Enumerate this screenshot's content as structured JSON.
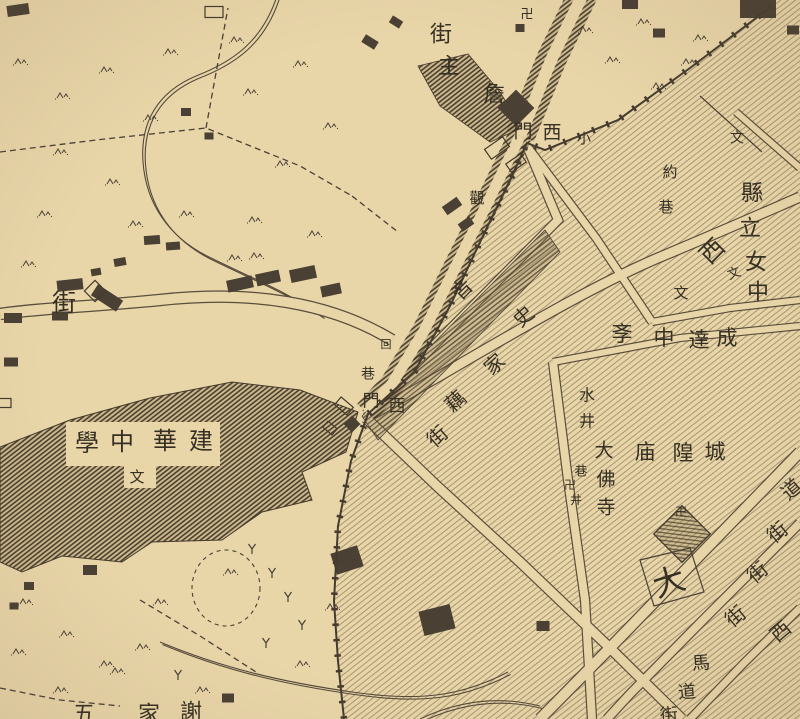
{
  "map": {
    "kind": "historical-city-map",
    "colors": {
      "paper": "#e8d5a8",
      "ink": "#3e362a",
      "ink_soft": "#5a4e3c",
      "building": "#4a4034",
      "text": "#352e24"
    },
    "place_names": [
      "詹主街",
      "小西門",
      "西門",
      "泉街",
      "回巷",
      "史家藕街",
      "觀",
      "約巷",
      "縣立女中",
      "西",
      "成達中斈",
      "城隍庙",
      "大佛寺",
      "水井",
      "巷井",
      "建華中學",
      "大",
      "道街",
      "街",
      "西街",
      "馬道街",
      "謝家五"
    ],
    "symbols": [
      "卍",
      "文",
      "回"
    ],
    "labels": [
      {
        "t": "卍",
        "x": 527,
        "y": 14,
        "s": 13
      },
      {
        "t": "街",
        "x": 441,
        "y": 34,
        "s": 22
      },
      {
        "t": "主",
        "x": 449,
        "y": 66,
        "s": 22
      },
      {
        "t": "詹",
        "x": 494,
        "y": 94,
        "s": 22
      },
      {
        "t": "門",
        "x": 523,
        "y": 132,
        "s": 19
      },
      {
        "t": "西",
        "x": 552,
        "y": 133,
        "s": 19
      },
      {
        "t": "小",
        "x": 584,
        "y": 140,
        "s": 14
      },
      {
        "t": "觀",
        "x": 477,
        "y": 199,
        "s": 15
      },
      {
        "t": "約",
        "x": 670,
        "y": 173,
        "s": 15
      },
      {
        "t": "巷",
        "x": 666,
        "y": 208,
        "s": 15
      },
      {
        "t": "文",
        "x": 737,
        "y": 139,
        "s": 14
      },
      {
        "t": "縣",
        "x": 752,
        "y": 193,
        "s": 22
      },
      {
        "t": "立",
        "x": 750,
        "y": 228,
        "s": 22
      },
      {
        "t": "女",
        "x": 756,
        "y": 262,
        "s": 22
      },
      {
        "t": "中",
        "x": 758,
        "y": 292,
        "s": 22
      },
      {
        "t": "西",
        "x": 713,
        "y": 252,
        "s": 24,
        "r": -45
      },
      {
        "t": "文",
        "x": 734,
        "y": 273,
        "s": 13,
        "r": -20
      },
      {
        "t": "文",
        "x": 681,
        "y": 294,
        "s": 15
      },
      {
        "t": "成",
        "x": 727,
        "y": 338,
        "s": 21
      },
      {
        "t": "達",
        "x": 699,
        "y": 340,
        "s": 21
      },
      {
        "t": "中",
        "x": 664,
        "y": 338,
        "s": 21
      },
      {
        "t": "斈",
        "x": 622,
        "y": 334,
        "s": 21
      },
      {
        "t": "音",
        "x": 463,
        "y": 290,
        "s": 20,
        "r": -45
      },
      {
        "t": "史",
        "x": 524,
        "y": 317,
        "s": 20,
        "r": -42
      },
      {
        "t": "家",
        "x": 495,
        "y": 365,
        "s": 20,
        "r": -42
      },
      {
        "t": "藕",
        "x": 456,
        "y": 402,
        "s": 20,
        "r": -42
      },
      {
        "t": "街",
        "x": 438,
        "y": 437,
        "s": 20,
        "r": -42
      },
      {
        "t": "回",
        "x": 386,
        "y": 345,
        "s": 11
      },
      {
        "t": "巷",
        "x": 368,
        "y": 375,
        "s": 14
      },
      {
        "t": "門",
        "x": 371,
        "y": 401,
        "s": 17
      },
      {
        "t": "西",
        "x": 397,
        "y": 406,
        "s": 17
      },
      {
        "t": "街",
        "x": 64,
        "y": 304,
        "s": 24
      },
      {
        "t": "建",
        "x": 201,
        "y": 442,
        "s": 24
      },
      {
        "t": "華",
        "x": 165,
        "y": 442,
        "s": 24
      },
      {
        "t": "中",
        "x": 122,
        "y": 443,
        "s": 24
      },
      {
        "t": "學",
        "x": 87,
        "y": 444,
        "s": 24
      },
      {
        "t": "文",
        "x": 137,
        "y": 478,
        "s": 15
      },
      {
        "t": "城",
        "x": 715,
        "y": 452,
        "s": 21
      },
      {
        "t": "隍",
        "x": 683,
        "y": 453,
        "s": 21
      },
      {
        "t": "庙",
        "x": 645,
        "y": 452,
        "s": 21
      },
      {
        "t": "大",
        "x": 604,
        "y": 451,
        "s": 19
      },
      {
        "t": "佛",
        "x": 606,
        "y": 480,
        "s": 19
      },
      {
        "t": "寺",
        "x": 606,
        "y": 508,
        "s": 19
      },
      {
        "t": "水",
        "x": 587,
        "y": 396,
        "s": 16
      },
      {
        "t": "井",
        "x": 587,
        "y": 422,
        "s": 16
      },
      {
        "t": "巷",
        "x": 581,
        "y": 471,
        "s": 13
      },
      {
        "t": "井",
        "x": 576,
        "y": 500,
        "s": 12
      },
      {
        "t": "卍",
        "x": 570,
        "y": 485,
        "s": 12
      },
      {
        "t": "卍",
        "x": 681,
        "y": 512,
        "s": 12
      },
      {
        "t": "大",
        "x": 669,
        "y": 582,
        "s": 32,
        "r": -18
      },
      {
        "t": "道",
        "x": 792,
        "y": 490,
        "s": 20,
        "r": -40
      },
      {
        "t": "街",
        "x": 778,
        "y": 533,
        "s": 20,
        "r": -40
      },
      {
        "t": "街",
        "x": 758,
        "y": 573,
        "s": 20,
        "r": -40
      },
      {
        "t": "街",
        "x": 736,
        "y": 617,
        "s": 20,
        "r": -40
      },
      {
        "t": "西",
        "x": 781,
        "y": 632,
        "s": 20,
        "r": -40
      },
      {
        "t": "馬",
        "x": 701,
        "y": 663,
        "s": 18,
        "r": -5
      },
      {
        "t": "道",
        "x": 687,
        "y": 692,
        "s": 18,
        "r": -5
      },
      {
        "t": "街",
        "x": 669,
        "y": 715,
        "s": 18,
        "r": -5
      },
      {
        "t": "謝",
        "x": 191,
        "y": 712,
        "s": 22
      },
      {
        "t": "家",
        "x": 149,
        "y": 714,
        "s": 22
      },
      {
        "t": "五",
        "x": 84,
        "y": 714,
        "s": 22
      }
    ],
    "geometry": {
      "city_region": "M 772,0 L 800,0 L 800,719 L 344,719 L 338,661 L 334,601 L 338,526 L 351,461 L 368,414 L 415,371 L 450,306 L 480,242 L 512,176 L 527,143 L 545,150 L 618,120 L 690,68 Z",
      "wall": "M 772,6 L 690,68 L 618,120 L 545,150 L 527,143 L 512,176 L 480,242 L 450,306 L 415,371 L 368,414 L 351,461 L 338,526 L 334,601 L 338,661 L 344,719",
      "streets": [
        {
          "d": "M 366,418 C 470,360 580,290 665,255 C 720,232 770,210 800,197",
          "w": 9
        },
        {
          "d": "M 366,414 L 558,220 L 527,146",
          "w": 8
        },
        {
          "d": "M 527,146 L 596,238 L 652,322",
          "w": 7
        },
        {
          "d": "M 652,322 L 730,308 L 800,300",
          "w": 6
        },
        {
          "d": "M 553,362 L 680,338 L 800,326",
          "w": 6
        },
        {
          "d": "M 553,362 L 568,480 L 585,600 L 592,719",
          "w": 8
        },
        {
          "d": "M 366,418 L 438,487 L 520,562 L 610,648 L 682,719",
          "w": 9
        },
        {
          "d": "M 800,452 L 700,555 L 606,652 L 540,719",
          "w": 10
        },
        {
          "d": "M 800,523 L 706,617 L 630,694 L 607,719",
          "w": 8
        },
        {
          "d": "M 800,608 L 744,663 L 690,719",
          "w": 7
        },
        {
          "d": "M 736,112 L 800,168",
          "w": 6
        }
      ],
      "flanked_roads": [
        {
          "d": "M 583,-6 L 552,58 L 520,136",
          "w": 12,
          "dark": 30
        },
        {
          "d": "M 520,136 L 488,202 L 455,268 L 424,331 L 392,384 L 366,412",
          "w": 11,
          "dark": 24
        }
      ],
      "edged_roads": [
        {
          "d": "M 392,340 C 330,302 250,290 160,300 C 100,306 40,308 0,314",
          "w": 10,
          "dark": 12.5
        }
      ],
      "island": "378,440 560,252 545,230 362,416",
      "mass": "0,447 70,420 150,398 232,382 300,390 358,412 346,452 302,472 312,500 262,512 222,540 152,542 122,562 62,556 22,572 0,562",
      "mass_holes": [
        [
          66,
          422,
          154,
          44
        ],
        [
          124,
          460,
          32,
          28
        ]
      ],
      "blob": "418,66 468,54 500,92 522,128 490,142 440,106",
      "buildings_solid": [
        [
          18,
          10,
          22,
          11,
          -8
        ],
        [
          370,
          42,
          15,
          9,
          32
        ],
        [
          396,
          22,
          12,
          8,
          32
        ],
        [
          152,
          240,
          16,
          9,
          -4
        ],
        [
          173,
          246,
          14,
          8,
          -4
        ],
        [
          186,
          112,
          10,
          8,
          0
        ],
        [
          209,
          136,
          9,
          7,
          0
        ],
        [
          120,
          262,
          12,
          8,
          -10
        ],
        [
          96,
          272,
          10,
          7,
          -10
        ],
        [
          60,
          316,
          16,
          9,
          0
        ],
        [
          13,
          318,
          18,
          10,
          0
        ],
        [
          11,
          362,
          14,
          9,
          0
        ],
        [
          240,
          284,
          26,
          12,
          -12
        ],
        [
          268,
          278,
          24,
          12,
          -12
        ],
        [
          303,
          274,
          26,
          13,
          -12
        ],
        [
          331,
          290,
          20,
          11,
          -12
        ],
        [
          70,
          285,
          26,
          11,
          -6
        ],
        [
          107,
          298,
          30,
          13,
          33
        ],
        [
          630,
          3,
          16,
          12,
          0
        ],
        [
          758,
          6,
          36,
          24,
          0
        ],
        [
          793,
          30,
          12,
          9,
          0
        ],
        [
          659,
          33,
          12,
          9,
          0
        ],
        [
          452,
          206,
          18,
          10,
          -35
        ],
        [
          466,
          224,
          14,
          9,
          -35
        ],
        [
          347,
          560,
          28,
          22,
          -18
        ],
        [
          437,
          620,
          32,
          25,
          -14
        ],
        [
          543,
          626,
          13,
          10,
          0
        ],
        [
          90,
          570,
          14,
          10,
          0
        ],
        [
          29,
          586,
          10,
          8,
          0
        ],
        [
          14,
          606,
          9,
          7,
          0
        ],
        [
          520,
          28,
          9,
          8,
          0
        ],
        [
          228,
          698,
          12,
          9,
          0
        ]
      ],
      "buildings_outline": [
        [
          214,
          12,
          18,
          11,
          0
        ],
        [
          5,
          403,
          12,
          9,
          0
        ],
        [
          497,
          148,
          22,
          12,
          -35
        ],
        [
          516,
          163,
          18,
          10,
          -35
        ],
        [
          344,
          406,
          16,
          10,
          40
        ],
        [
          330,
          428,
          12,
          8,
          40
        ]
      ],
      "diamonds_solid": [
        [
          516,
          108,
          26
        ],
        [
          352,
          424,
          12
        ]
      ],
      "diamonds_outline": [
        [
          95,
          291,
          15
        ]
      ],
      "temple_diamond": [
        682,
        534,
        40
      ],
      "block_lines": [
        "M 700,96 L 762,152",
        "M 640,560 L 690,548 L 704,592 L 654,606 Z"
      ],
      "tufts": [
        [
          20,
          62
        ],
        [
          62,
          96
        ],
        [
          106,
          70
        ],
        [
          170,
          52
        ],
        [
          236,
          40
        ],
        [
          300,
          64
        ],
        [
          150,
          118
        ],
        [
          60,
          152
        ],
        [
          112,
          182
        ],
        [
          44,
          214
        ],
        [
          250,
          92
        ],
        [
          330,
          126
        ],
        [
          282,
          164
        ],
        [
          186,
          214
        ],
        [
          254,
          220
        ],
        [
          314,
          234
        ],
        [
          28,
          264
        ],
        [
          234,
          258
        ],
        [
          256,
          256
        ],
        [
          135,
          224
        ],
        [
          585,
          30
        ],
        [
          612,
          60
        ],
        [
          643,
          22
        ],
        [
          658,
          86
        ],
        [
          700,
          38
        ],
        [
          688,
          62
        ],
        [
          25,
          602
        ],
        [
          66,
          634
        ],
        [
          106,
          664
        ],
        [
          160,
          602
        ],
        [
          60,
          690
        ],
        [
          18,
          652
        ],
        [
          142,
          647
        ],
        [
          202,
          690
        ],
        [
          302,
          664
        ],
        [
          332,
          607
        ],
        [
          117,
          671
        ],
        [
          230,
          572
        ]
      ],
      "trees": [
        [
          252,
          546
        ],
        [
          272,
          570
        ],
        [
          288,
          594
        ],
        [
          302,
          622
        ],
        [
          266,
          640
        ],
        [
          178,
          672
        ]
      ],
      "streams": [
        "M 277,-4 C 262,42 232,62 196,76 C 158,92 140,122 143,162 C 146,203 168,236 207,256 C 247,276 288,292 322,316",
        "M 160,642 C 222,668 282,682 352,692 C 420,702 462,696 508,672",
        "M 420,719 C 460,700 500,696 540,706"
      ],
      "dashes": [
        "M 0,152 L 96,140 L 206,128 L 300,166 L 352,196",
        "M 206,128 L 218,62 L 228,8",
        "M 352,196 L 398,232",
        "M 140,600 L 200,636 L 256,672",
        "M 0,688 L 60,700 L 120,706"
      ],
      "dash_ellipse": {
        "cx": 226,
        "cy": 588,
        "rx": 34,
        "ry": 38
      }
    }
  }
}
